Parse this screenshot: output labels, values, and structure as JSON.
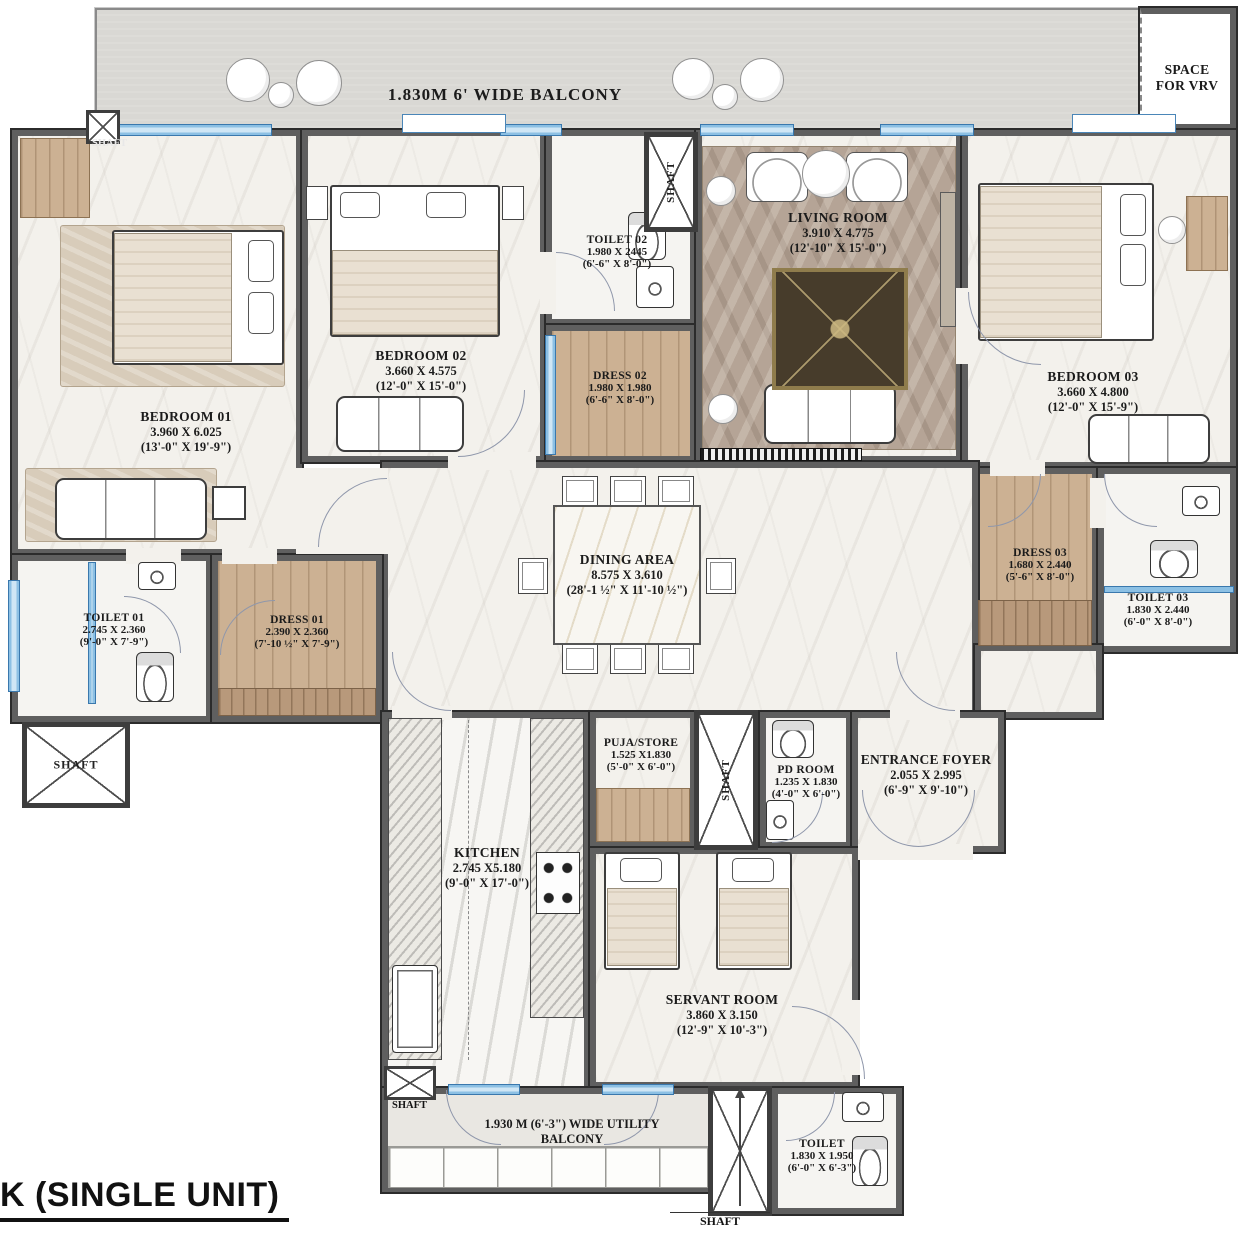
{
  "title": "K (SINGLE UNIT)",
  "labels": {
    "balcony": "1.830M 6' WIDE  BALCONY",
    "vrv_line1": "SPACE",
    "vrv_line2": "FOR VRV",
    "shaft": "SHAFT",
    "utility_line1": "1.930 M (6'-3\") WIDE UTILITY",
    "utility_line2": "BALCONY"
  },
  "colors": {
    "wall": "#5f5f5f",
    "window_glass": "#cfe6f5",
    "window_frame": "#3a78ad",
    "wood_floor": "#ccb193",
    "plant_green": "#5a8243"
  },
  "rooms": {
    "bedroom01": {
      "name": "BEDROOM 01",
      "m": "3.960 X 6.025",
      "ft": "(13'-0\" X 19'-9\")"
    },
    "bedroom02": {
      "name": "BEDROOM 02",
      "m": "3.660 X 4.575",
      "ft": "(12'-0\" X 15'-0\")"
    },
    "toilet02": {
      "name": "TOILET 02",
      "m": "1.980 X 2445",
      "ft": "(6'-6\" X 8'-0\")"
    },
    "dress02": {
      "name": "DRESS 02",
      "m": "1.980 X 1.980",
      "ft": "(6'-6\" X 8'-0\")"
    },
    "livingroom": {
      "name": "LIVING ROOM",
      "m": "3.910 X 4.775",
      "ft": "(12'-10\" X 15'-0\")"
    },
    "bedroom03": {
      "name": "BEDROOM 03",
      "m": "3.660 X 4.800",
      "ft": "(12'-0\" X 15'-9\")"
    },
    "dress03": {
      "name": "DRESS 03",
      "m": "1.680 X 2.440",
      "ft": "(5'-6\" X 8'-0\")"
    },
    "toilet03": {
      "name": "TOILET 03",
      "m": "1.830 X 2.440",
      "ft": "(6'-0\" X 8'-0\")"
    },
    "dining": {
      "name": "DINING AREA",
      "m": "8.575 X 3.610",
      "ft": "(28'-1 ½\" X 11'-10 ½\")"
    },
    "toilet01": {
      "name": "TOILET 01",
      "m": "2.745 X 2.360",
      "ft": "(9'-0\" X 7'-9\")"
    },
    "dress01": {
      "name": "DRESS 01",
      "m": "2.390 X 2.360",
      "ft": "(7'-10 ½\" X 7'-9\")"
    },
    "kitchen": {
      "name": "KITCHEN",
      "m": "2.745 X5.180",
      "ft": "(9'-0\" X 17'-0\")"
    },
    "puja": {
      "name": "PUJA/STORE",
      "m": "1.525 X1.830",
      "ft": "(5'-0\" X 6'-0\")"
    },
    "pdroom": {
      "name": "PD ROOM",
      "m": "1.235 X 1.830",
      "ft": "(4'-0\" X 6'-0\")"
    },
    "foyer": {
      "name": "ENTRANCE FOYER",
      "m": "2.055 X 2.995",
      "ft": "(6'-9\" X 9'-10\")"
    },
    "servant": {
      "name": "SERVANT ROOM",
      "m": "3.860 X 3.150",
      "ft": "(12'-9\" X 10'-3\")"
    },
    "toiletU": {
      "name": "TOILET",
      "m": "1.830 X 1.950",
      "ft": "(6'-0\" X 6'-3\")"
    }
  }
}
